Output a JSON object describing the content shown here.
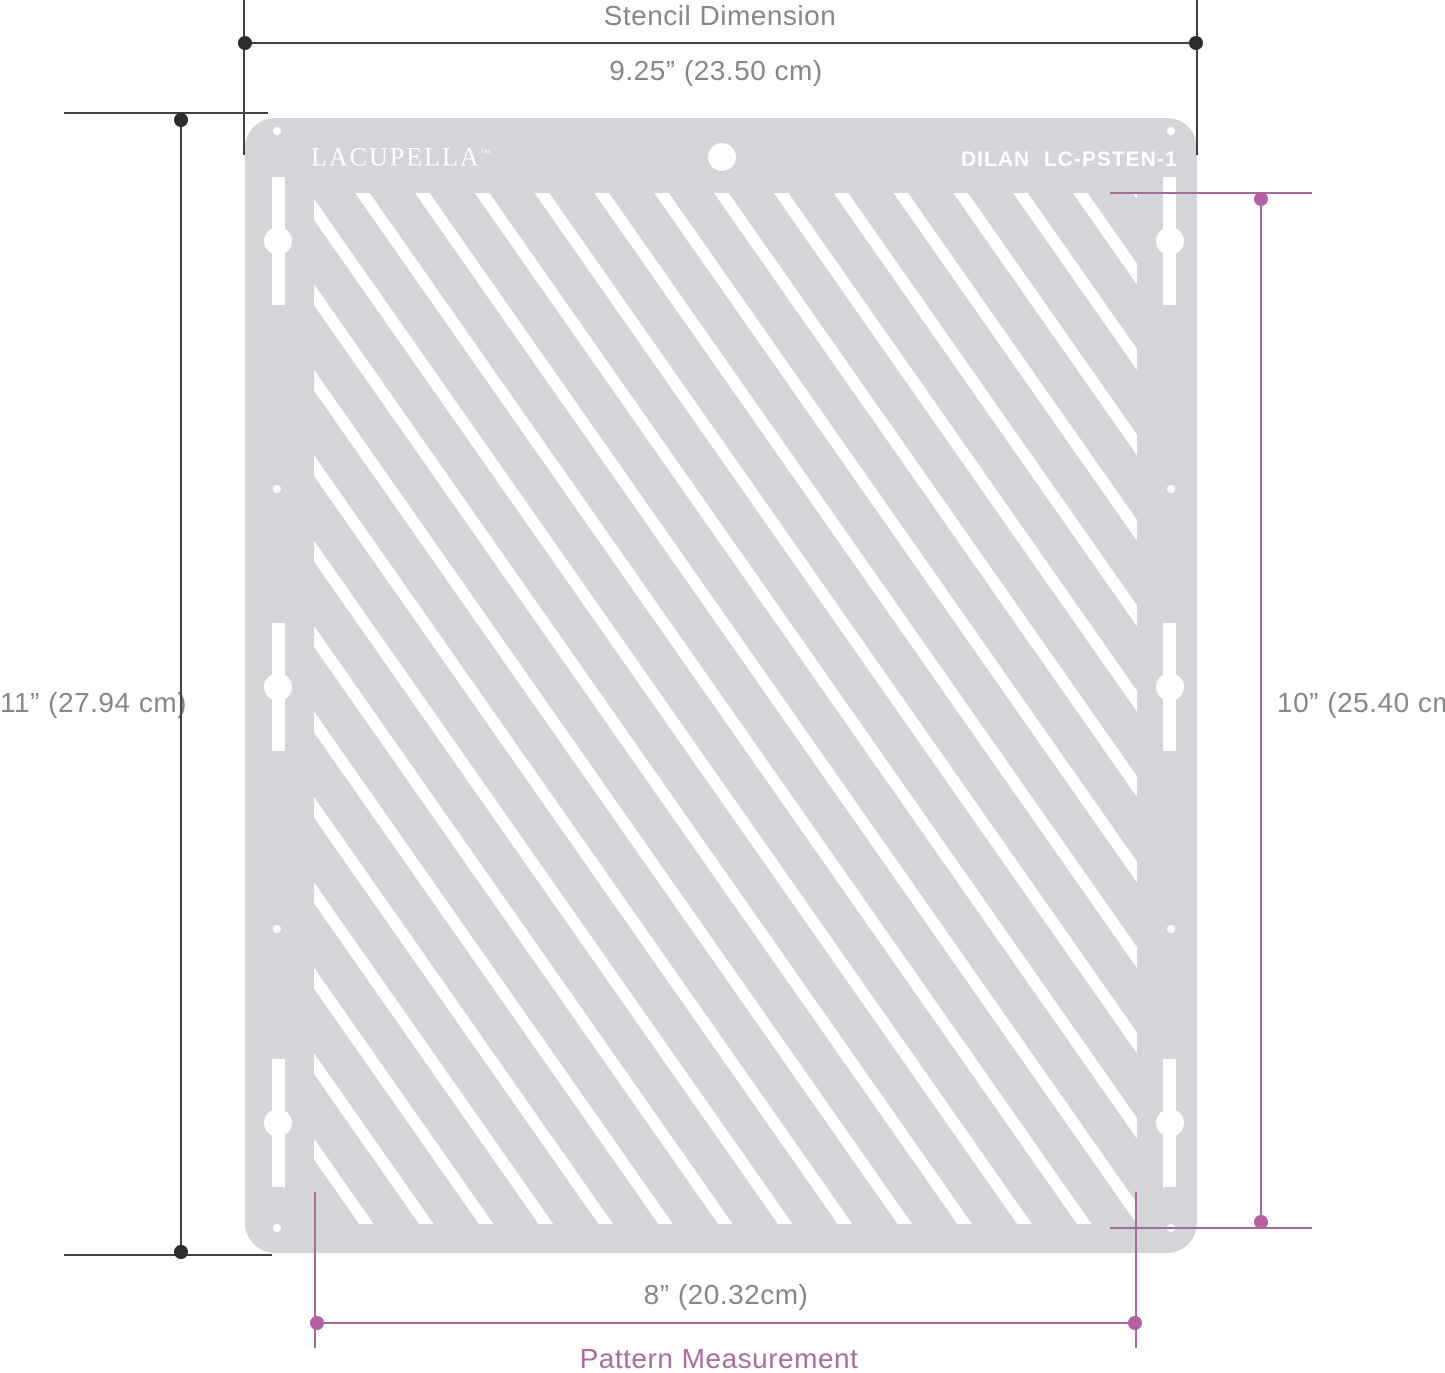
{
  "top_dimension": {
    "label": "Stencil Dimension",
    "value": "9.25” (23.50 cm)"
  },
  "left_dimension": {
    "value": "11” (27.94 cm)"
  },
  "right_dimension": {
    "value": "10” (25.40 cm)"
  },
  "bottom_dimension": {
    "value": "8” (20.32cm)",
    "label": "Pattern Measurement"
  },
  "stencil": {
    "brand": "LACUPELLA",
    "trademark": "™",
    "model": "DILAN  LC-PSTEN-1"
  },
  "colors": {
    "stencil_body": "#d3d5d8",
    "cutout": "#ffffff",
    "dim_line": "#414144",
    "dim_dot": "#2d2d30",
    "text_gray": "#84878c",
    "accent_line": "#a7689a",
    "accent_dot": "#b55fa5",
    "accent_text": "#a76f9e"
  }
}
